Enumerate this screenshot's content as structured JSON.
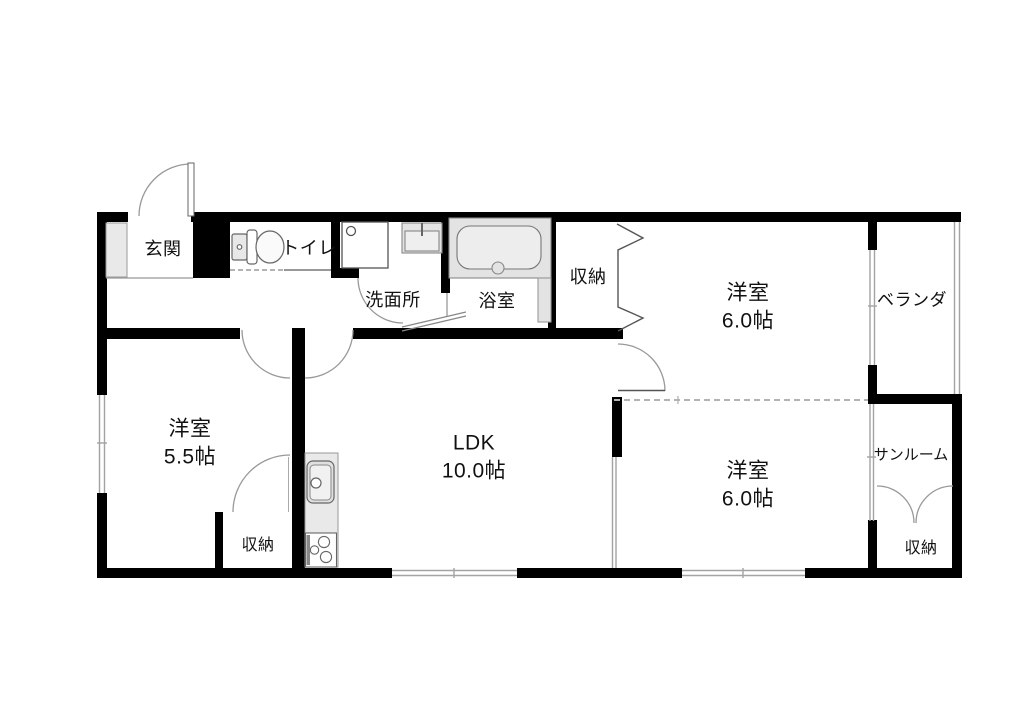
{
  "rooms": {
    "genkan": {
      "label": "玄関"
    },
    "toilet": {
      "label": "トイレ"
    },
    "washroom": {
      "label": "洗面所"
    },
    "bathroom": {
      "label": "浴室"
    },
    "closet_hall": {
      "label": "収納"
    },
    "bedroom_ne": {
      "label": "洋室",
      "size": "6.0帖"
    },
    "veranda": {
      "label": "ベランダ"
    },
    "bedroom_w": {
      "label": "洋室",
      "size": "5.5帖"
    },
    "ldk": {
      "label": "LDK",
      "size": "10.0帖"
    },
    "bedroom_se": {
      "label": "洋室",
      "size": "6.0帖"
    },
    "sunroom": {
      "label": "サンルーム"
    },
    "closet_w": {
      "label": "収納"
    },
    "closet_se": {
      "label": "収納"
    }
  },
  "fixtures": [
    "toilet-icon",
    "washing-machine-pan-icon",
    "wash-basin-icon",
    "bathtub-icon",
    "kitchen-sink-icon",
    "stove-icon",
    "shoe-cabinet-icon"
  ],
  "colors": {
    "wall": "#000000",
    "fixture_fill": "#e9e9e9",
    "fixture_stroke": "#777777",
    "line_gray": "#9a9a9a",
    "text": "#111111",
    "background": "#ffffff"
  }
}
